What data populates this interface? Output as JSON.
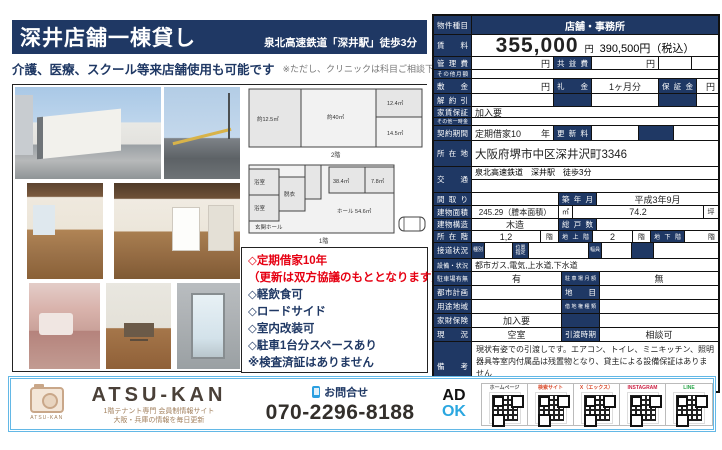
{
  "header": {
    "title": "深井店舗一棟貸し",
    "station": "泉北高速鉄道「深井駅」徒歩3分",
    "subtitle": "介護、医療、スクール等来店舗使用も可能です",
    "subtitle_note": "※ただし、クリニックは科目ご相談下さい"
  },
  "accent_colors": {
    "navy": "#1f3864",
    "red": "#e60012",
    "footer_blue": "#63b8e6"
  },
  "features": {
    "items": [
      {
        "text": "◇定期借家10年",
        "style": "color:#e60012"
      },
      {
        "text": "（更新は双方協議のもととなります）",
        "style": "color:#e60012"
      },
      {
        "text": "◇軽飲食可",
        "style": "color:#1f3864"
      },
      {
        "text": "◇ロードサイド",
        "style": "color:#1f3864"
      },
      {
        "text": "◇室内改装可",
        "style": "color:#1f3864"
      },
      {
        "text": "◇駐車1台分スペースあり",
        "style": "color:#1f3864"
      },
      {
        "text": "※検査済証はありません",
        "style": "color:#1f3864"
      }
    ]
  },
  "floorplan": {
    "floor2": {
      "room_left": "約12.5㎡",
      "room_center": "約40㎡",
      "room_top_right": "12.4㎡",
      "room_bottom_right": "14.5㎡",
      "caption": "2階"
    },
    "floor1": {
      "room_bath1": "浴室",
      "room_bath2": "浴室",
      "room_datsui": "脱衣",
      "room_entrance": "玄関ホール",
      "room_hall": "ホール 54.6㎡",
      "room_a": "38.4㎡",
      "room_b": "7.8㎡",
      "caption": "1階"
    }
  },
  "table": {
    "property_type_label": "物件種目",
    "property_type": "店舗・事務所",
    "rent_label": "賃料",
    "rent": "355,000",
    "rent_unit": "円",
    "rent_tax": "390,500円（税込）",
    "mgmt_label": "管理費",
    "mgmt_unit": "円",
    "kyoueki_label": "共益費",
    "kyoueki_unit": "円",
    "other_monthly_label": "その他月額",
    "shikikin_label": "敷金",
    "shikikin_unit": "円",
    "reikin_label": "礼金",
    "reikin": "1ヶ月分",
    "hoshokin_label": "保証金",
    "hoshokin_unit": "円",
    "kaiyaku_label": "解約引",
    "yachin_hosho_label": "家賃保証",
    "yachin_hosho": "加入要",
    "other_onetime_label": "その他一時金",
    "keiyaku_label": "契約期間",
    "keiyaku": "定期借家10",
    "keiyaku_unit": "年",
    "koshin_label": "更新料",
    "address_label": "所在地",
    "address": "大阪府堺市中区深井沢町3346",
    "access_label": "交通",
    "access": "泉北高速鉄道　深井駅　徒歩3分",
    "madori_label": "間取り",
    "chiku_label": "築年月",
    "chiku": "平成3年9月",
    "area_label": "建物面積",
    "area": "245.29（謄本面積）",
    "area_unit": "㎡",
    "tsubo": "74.2",
    "tsubo_unit": "坪",
    "structure_label": "建物構造",
    "structure": "木造",
    "soukosu_label": "総戸数",
    "floor_label": "所在階",
    "floor": "1,2",
    "floor_unit": "階",
    "ground_label": "地上階",
    "ground": "2",
    "ground_unit": "階",
    "basement_label": "地下階",
    "basement_unit": "階",
    "road_label": "接道状況",
    "road_type_label": "種別",
    "road_pos_label": "位置指定",
    "road_width_label": "幅員",
    "setsubi_label": "設備・状況",
    "setsubi": "都市ガス,電気,上水道,下水道",
    "parking_label": "駐車場有無",
    "parking": "有",
    "parking_fee_label": "駐車場月額",
    "parking_fee": "無",
    "toshi_label": "都市計画",
    "chimoku_label": "地目",
    "yoto_label": "用途地域",
    "shakuchi_label": "借地権種類",
    "kazai_label": "家財保険",
    "kazai": "加入要",
    "genkyo_label": "現況",
    "genkyo": "空室",
    "hikiwatashi_label": "引渡時期",
    "hikiwatashi": "相談可",
    "biko_label": "備考",
    "biko": "現状有姿での引渡しです。エアコン、トイレ、ミニキッチン、照明器具等室内付属品は残置物となり、貸主による設備保証はありません"
  },
  "footer": {
    "brand": "ATSU-KAN",
    "logo_caption": "ATSU-KAN",
    "brand_sub1": "1階テナント専門 会員制情報サイト",
    "brand_sub2": "大阪・兵庫の情報を毎日更新",
    "contact_label": "お問合せ",
    "phone": "070-2296-8188",
    "ad": "AD",
    "ok": "OK",
    "qr": [
      {
        "label": "ホームページ",
        "label_style": "color:#555555"
      },
      {
        "label": "検索サイト",
        "label_style": "color:#d94a2a"
      },
      {
        "label": "X（エックス）",
        "label_style": "color:#d94a2a"
      },
      {
        "label": "INSTAGRAM",
        "label_style": "color:#cc2244"
      },
      {
        "label": "LINE",
        "label_style": "color:#2aa64a"
      }
    ]
  }
}
